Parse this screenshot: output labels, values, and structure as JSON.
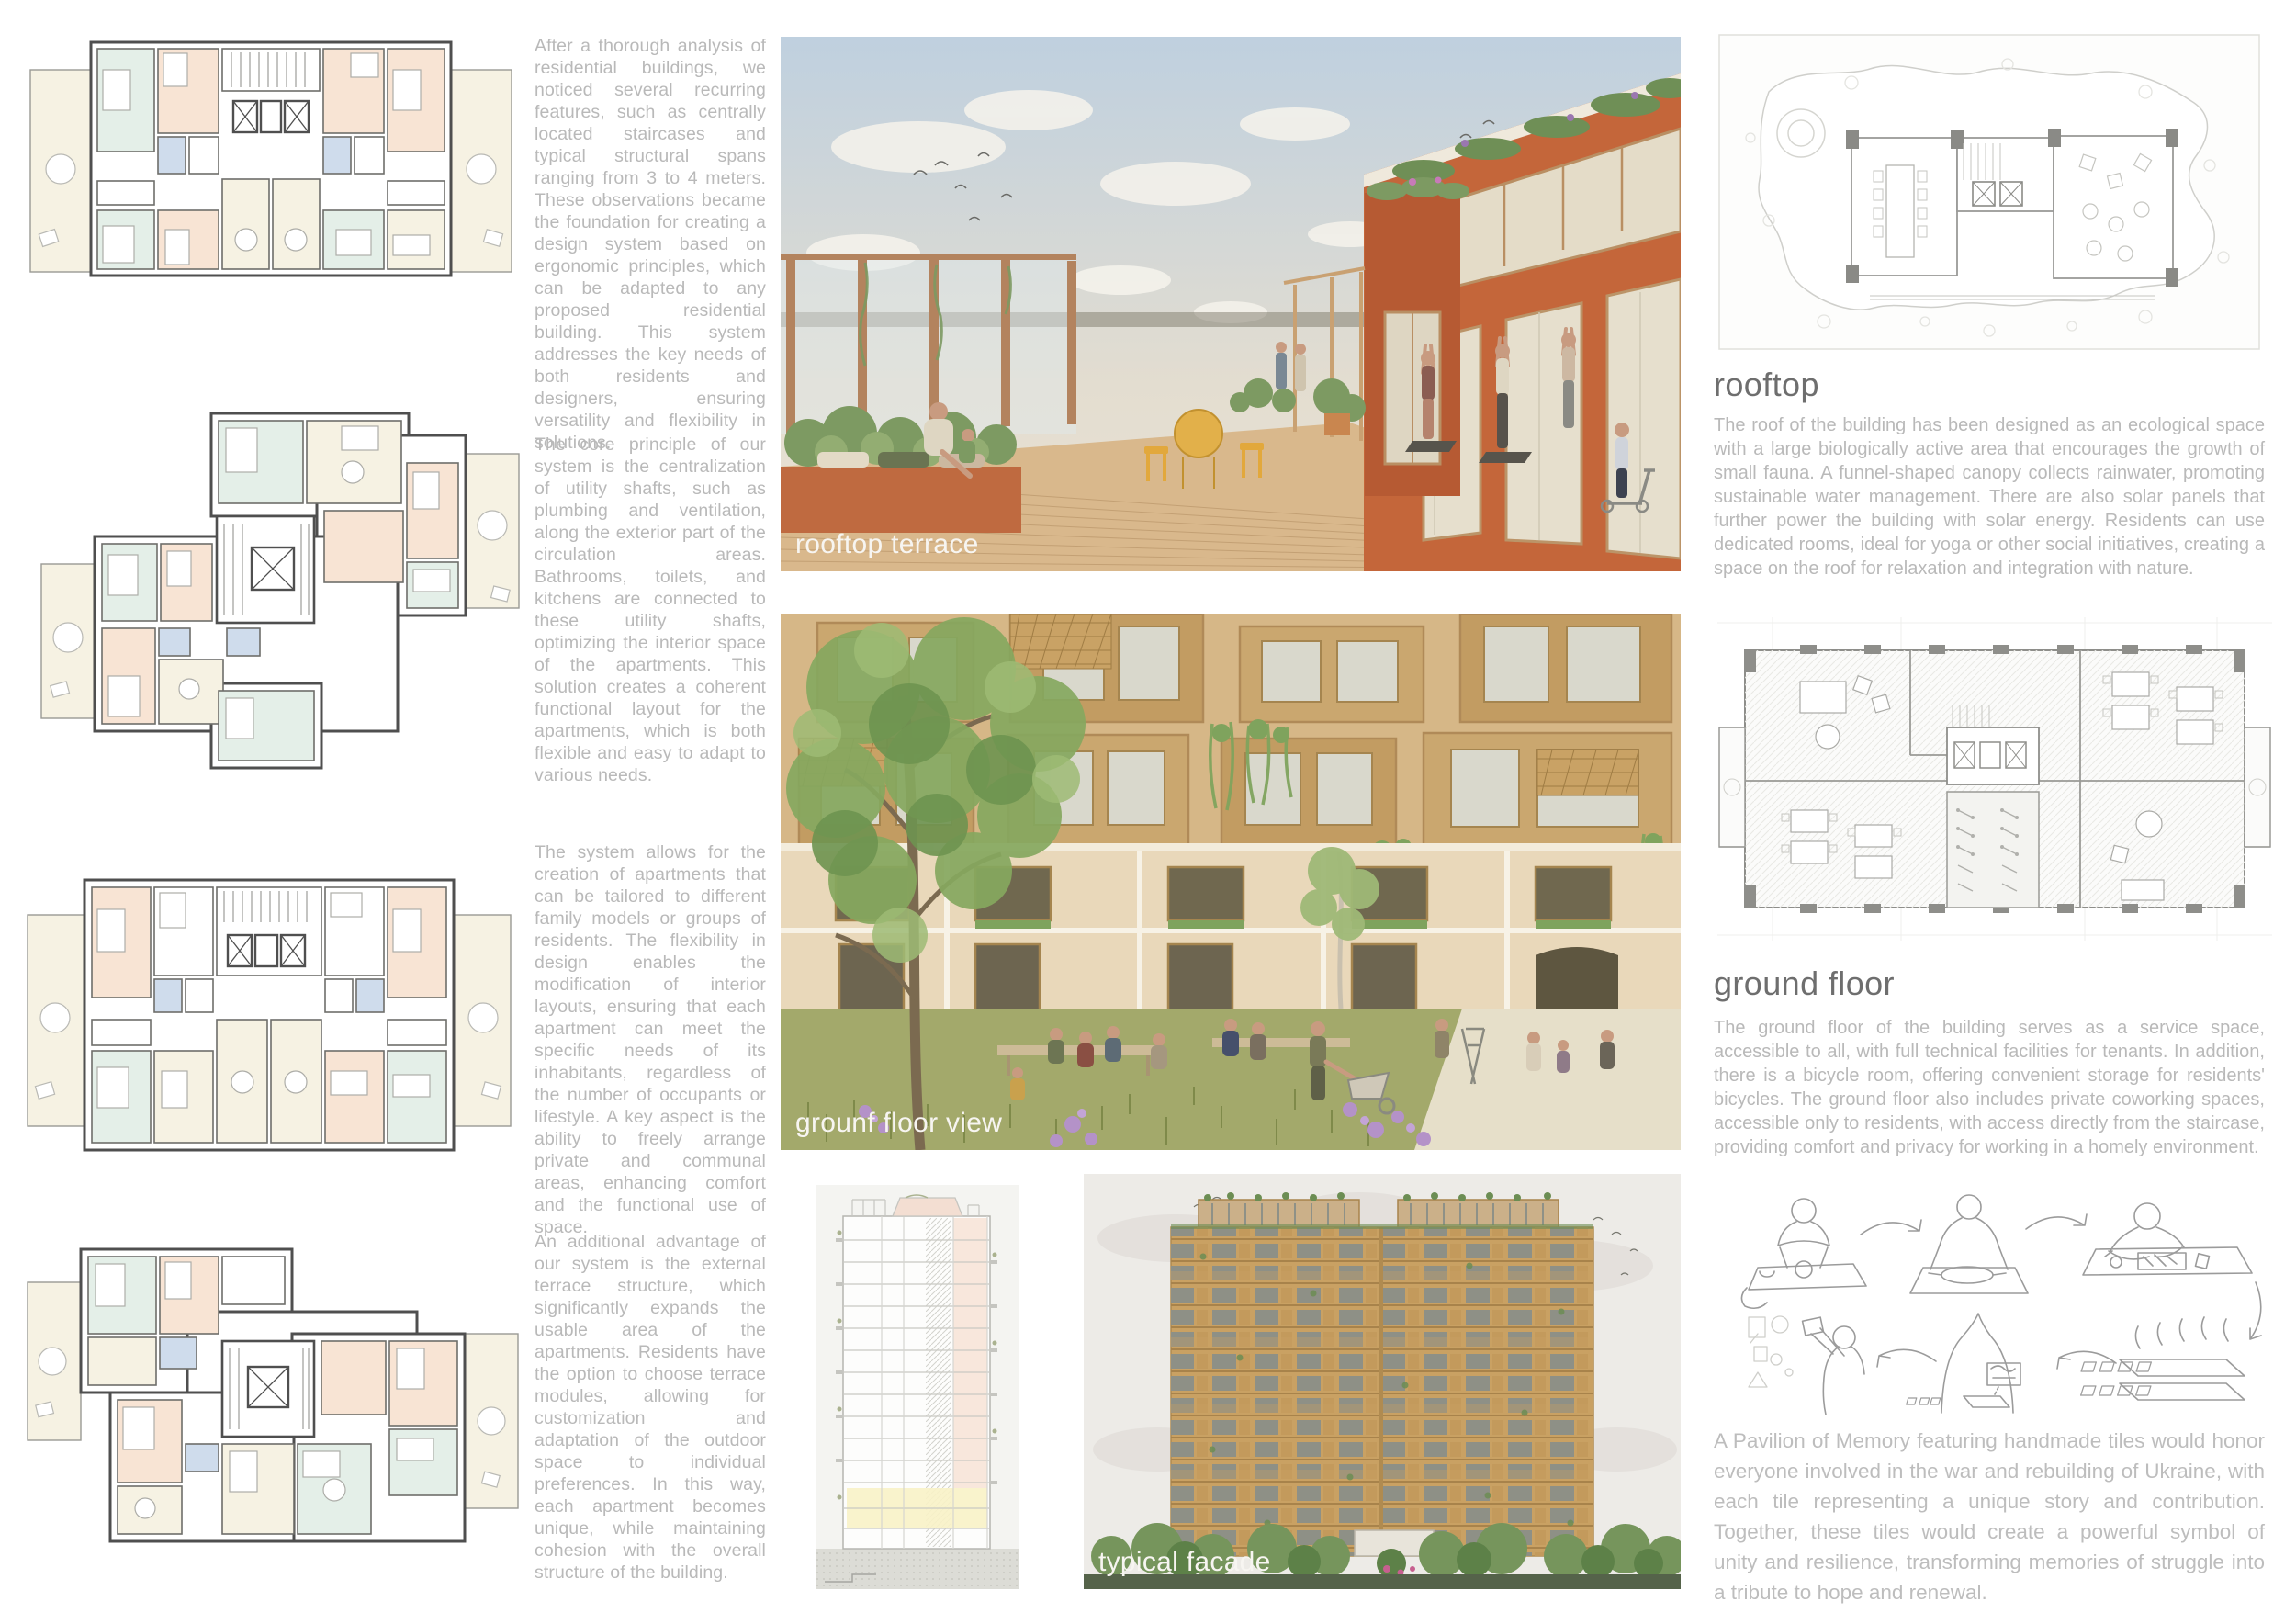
{
  "left_column": {
    "paragraphs": [
      "After a thorough analysis of residential buildings, we noticed several recurring features, such as centrally located staircases and typical structural spans ranging from 3 to 4 meters. These observations became the foundation for creating a design system based on ergonomic principles, which can be adapted to any proposed residential building. This system addresses the key needs of both residents and designers, ensuring versatility and flexibility in solutions.",
      "The core principle of our system is the centralization of utility shafts, such as plumbing and ventilation, along the exterior part of the circulation areas. Bathrooms, toilets, and kitchens are connected to these utility shafts, optimizing the interior space of the apartments. This solution creates a coherent functional layout for the apartments, which is both flexible and easy to adapt to various needs.",
      "The system allows for the creation of apartments that can be tailored to different family models or groups of residents. The flexibility in design enables the modification of interior layouts, ensuring that each apartment can meet the specific needs of its inhabitants, regardless of the number of occupants or lifestyle. A key aspect is the ability to freely arrange private and communal areas, enhancing comfort and the functional use of space.",
      "An additional advantage of our system is the external terrace structure, which significantly expands the usable area of the apartments. Residents have the option to choose terrace modules, allowing for customization and adaptation of the outdoor space to individual preferences. In this way, each apartment becomes unique, while maintaining cohesion with the overall structure of the building."
    ]
  },
  "renders": {
    "rooftop_terrace_label": "rooftop terrace",
    "ground_floor_view_label": "grounf floor view",
    "typical_facade_label": "typical facade"
  },
  "right_column": {
    "rooftop_heading": "rooftop",
    "rooftop_body": "The roof of the building has been designed as an ecological space with a large biologically active area that encourages the growth of small fauna. A funnel-shaped canopy collects rainwater, promoting sustainable water management. There are also solar panels that further power the building with solar energy. Residents can use dedicated rooms, ideal for yoga or other social initiatives, creating a space on the roof for relaxation and integration with nature.",
    "ground_floor_heading": "ground floor",
    "ground_floor_body": "The ground floor of the building serves as a service space, accessible to all, with full technical facilities for tenants. In addition, there is a bicycle room, offering convenient storage for residents' bicycles. The ground floor also includes private coworking spaces, accessible only to residents, with access directly from the staircase, providing comfort and privacy for working in a homely environment.",
    "pavilion_body": "A Pavilion of Memory featuring handmade tiles would honor everyone involved in the war and rebuilding of Ukraine, with each tile representing a unique story and contribution. Together, these tiles would create a powerful symbol of unity and resilience, transforming memories of struggle into a tribute to hope and renewal."
  },
  "palette": {
    "body_text": "#b9b9b9",
    "heading_text": "#6e6e6e",
    "plan_outline": "#4f4f4f",
    "plan_peach": "#f8e4d4",
    "plan_mint": "#e4efe8",
    "plan_cream": "#f6f2e3",
    "plan_blue": "#cfdcec",
    "render_orange": "#c4663a",
    "render_wood": "#d9b88c",
    "render_green": "#7d9a5e",
    "sky_blue": "#c3d3e2",
    "image_label_text": "#f7f5f1"
  }
}
